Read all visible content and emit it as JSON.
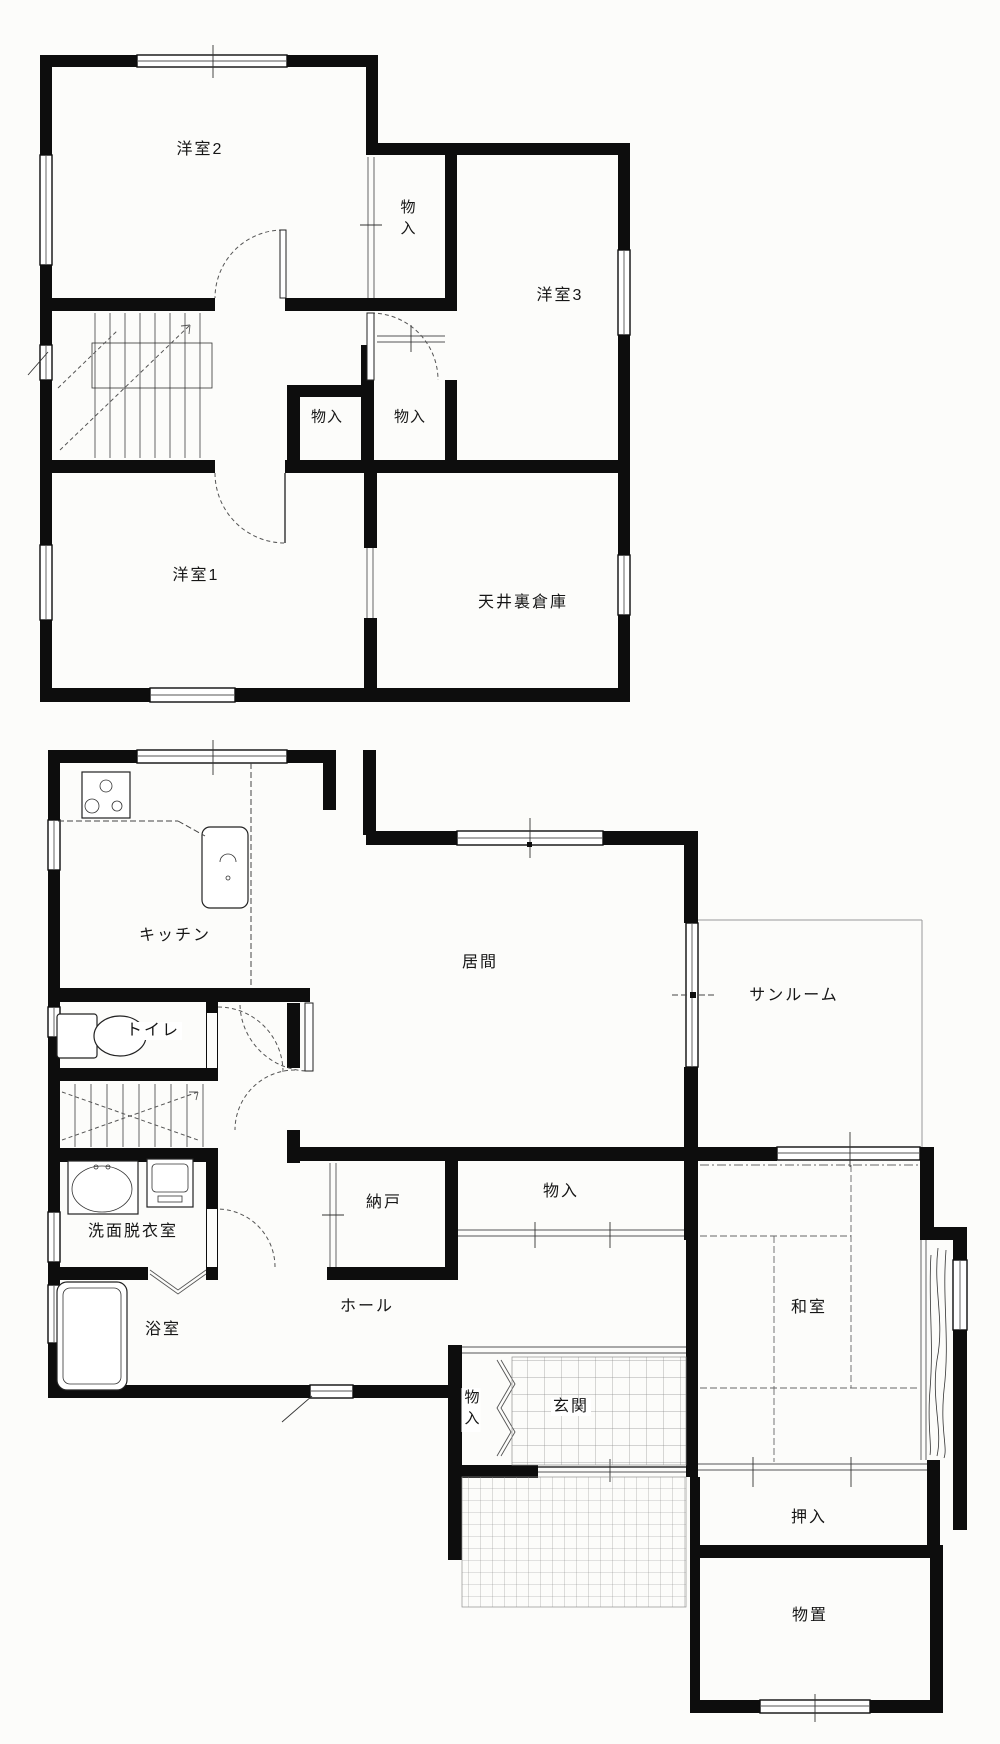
{
  "document": {
    "type": "floor-plan",
    "floors": [
      "2F",
      "1F"
    ]
  },
  "colors": {
    "wall": "#0d0d0d",
    "paper": "#fcfcfa",
    "thin_line": "#555555",
    "grid_line": "#999999"
  },
  "plans": {
    "second_floor": {
      "rooms": {
        "yoshitsu2": "洋室2",
        "monoire_upper": "物入",
        "yoshitsu3": "洋室3",
        "monoire_left": "物入",
        "monoire_right": "物入",
        "yoshitsu1": "洋室1",
        "tenjoura_soko": "天井裏倉庫"
      }
    },
    "first_floor": {
      "rooms": {
        "kitchen": "キッチン",
        "ima": "居間",
        "sunroom": "サンルーム",
        "toilet": "トイレ",
        "nando": "納戸",
        "monoire": "物入",
        "senmen_datsuiishitsu": "洗面脱衣室",
        "hall": "ホール",
        "bath": "浴室",
        "washitsu": "和室",
        "genkan": "玄関",
        "genkan_monoire": "物入",
        "oshiire": "押入",
        "monooki": "物置"
      }
    }
  }
}
